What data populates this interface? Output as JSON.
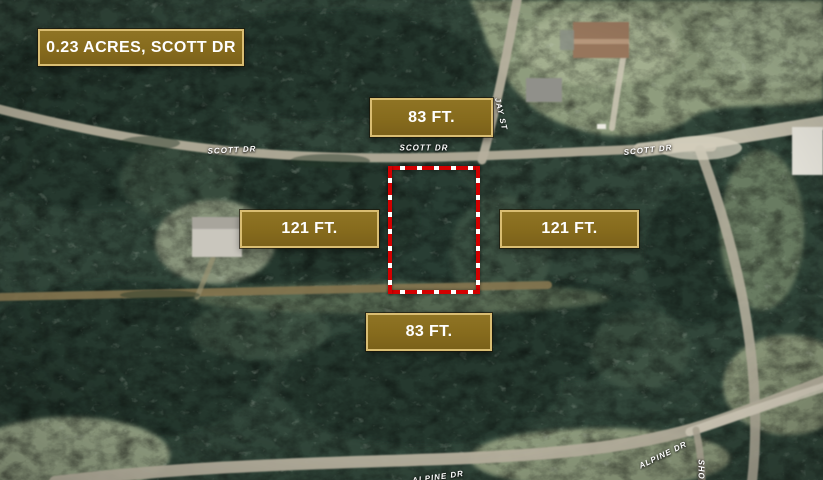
{
  "map": {
    "title_badge": "0.23 ACRES, SCOTT DR",
    "dimensions": {
      "top": "83 FT.",
      "left": "121 FT.",
      "right": "121 FT.",
      "bottom": "83 FT."
    },
    "streets": {
      "scott_dr_left": "SCOTT DR",
      "scott_dr_center": "SCOTT DR",
      "scott_dr_right": "SCOTT DR",
      "jay_st": "JAY ST",
      "alpine_dr_center": "ALPINE DR",
      "alpine_dr_right": "ALPINE DR",
      "short_street_partial": "SHOR"
    },
    "colors": {
      "badge_fill": "#866b1d",
      "badge_border": "#d9bd72",
      "badge_text": "#ffffff",
      "lot_outline": "#d30000",
      "lot_outline_dash": "#ffffff"
    }
  }
}
